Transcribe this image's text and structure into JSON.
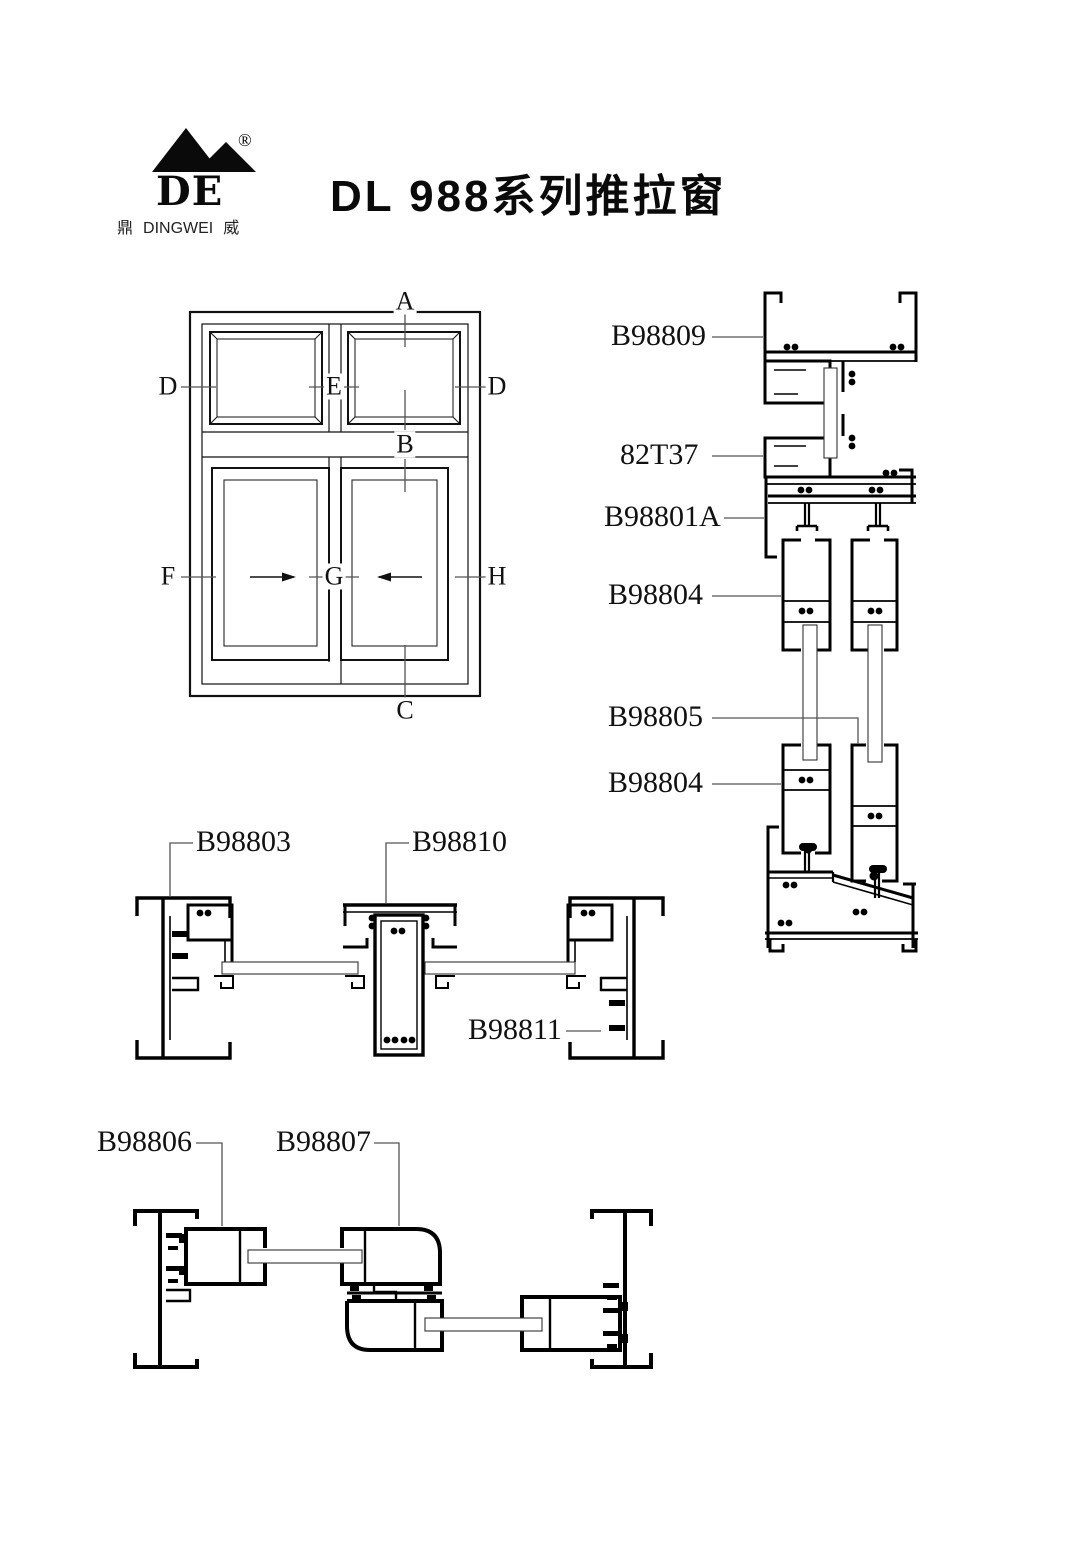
{
  "page": {
    "background": "#ffffff",
    "line_color": "#000000",
    "leader_color": "#555555",
    "glass_fill": "#ffffff"
  },
  "header": {
    "title": "DL 988系列推拉窗",
    "logo": {
      "letters": "DE",
      "registered": "®",
      "cn_left": "鼎",
      "name_en": "DINGWEI",
      "cn_right": "威"
    }
  },
  "elevation": {
    "labels": {
      "a": "A",
      "b": "B",
      "c": "C",
      "d_left": "D",
      "d_right": "D",
      "e": "E",
      "f": "F",
      "g": "G",
      "h": "H"
    }
  },
  "vertical_section": {
    "labels": {
      "head_frame": "B98809",
      "transom": "82T37",
      "slider_frame": "B98801A",
      "sash_top": "B98804",
      "sash_bottom_right": "B98805",
      "sash_bottom_left": "B98804"
    }
  },
  "mid_section": {
    "labels": {
      "left_jamb": "B98803",
      "mullion": "B98810",
      "right_jamb": "B98811"
    }
  },
  "bottom_section": {
    "labels": {
      "left_sash": "B98806",
      "interlock_sash": "B98807"
    }
  }
}
